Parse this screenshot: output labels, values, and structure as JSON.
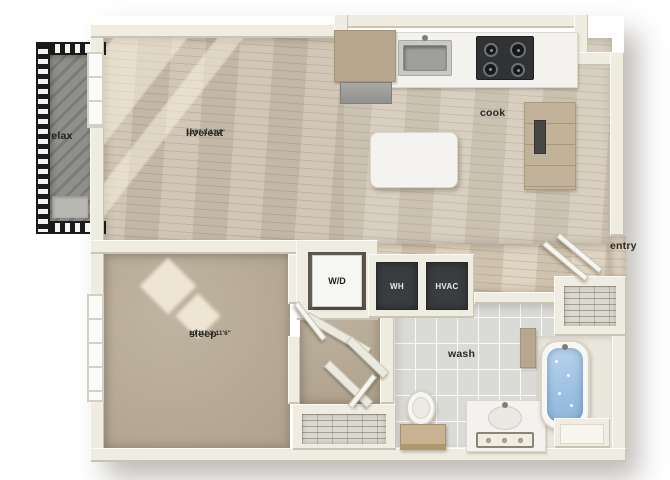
{
  "floorplan": {
    "rooms": {
      "live_eat": {
        "name": "live/eat",
        "dimensions": "12'9\" X 13'2\""
      },
      "cook": {
        "name": "cook"
      },
      "relax": {
        "name": "relax"
      },
      "entry": {
        "name": "entry"
      },
      "sleep": {
        "name": "sleep",
        "dimensions": "10'11\" X 11'6\""
      },
      "wash": {
        "name": "wash"
      }
    },
    "equipment": {
      "washer_dryer": {
        "label": "W/D"
      },
      "water_heater": {
        "label": "WH"
      },
      "hvac": {
        "label": "HVAC"
      }
    },
    "colors": {
      "wall": "#efece1",
      "wood_floor": "#cdc1ae",
      "carpet": "#b9ac97",
      "tile": "#dadad6",
      "balcony_concrete": "#8f8f8b",
      "tub_water": "#9cc0e2",
      "equipment_dark": "#3a3d3f",
      "cabinet_wood": "#c3b29a"
    }
  }
}
